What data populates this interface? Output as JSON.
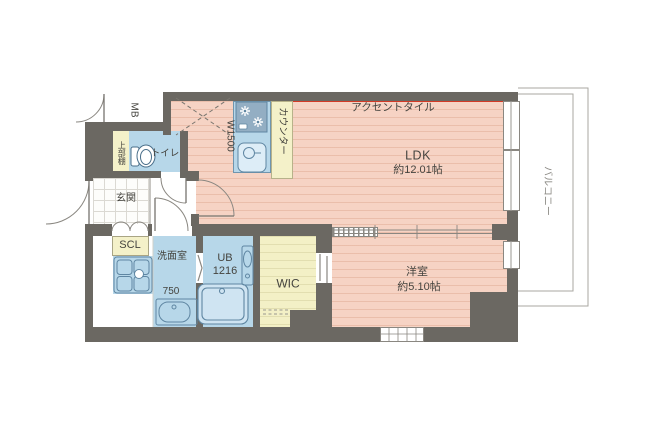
{
  "plan": {
    "rooms": {
      "ldk": {
        "name": "LDK",
        "size": "約12.01帖"
      },
      "western": {
        "name": "洋室",
        "size": "約5.10帖"
      },
      "wic": {
        "name": "WIC"
      },
      "unit_bath": {
        "name": "UB",
        "size": "1216"
      },
      "washroom": {
        "name": "洗面室",
        "pan_size": "750"
      },
      "toilet": {
        "name": "トイレ"
      },
      "genkan": {
        "name": "玄関"
      },
      "scl": {
        "name": "SCL"
      },
      "shelf": {
        "name": "上部棚"
      },
      "meter_box": {
        "name": "MB"
      },
      "balcony": {
        "name": "バルコニー"
      }
    },
    "annotations": {
      "accent_tile": "アクセントタイル",
      "counter": "カウンター",
      "kitchen_width": "W1500"
    },
    "colors": {
      "wall": "#6b6862",
      "flooring": "#f6d3c4",
      "wet_area": "#b7d7e9",
      "storage": "#f4f1c9",
      "accent_tile": "#d23a26"
    }
  }
}
